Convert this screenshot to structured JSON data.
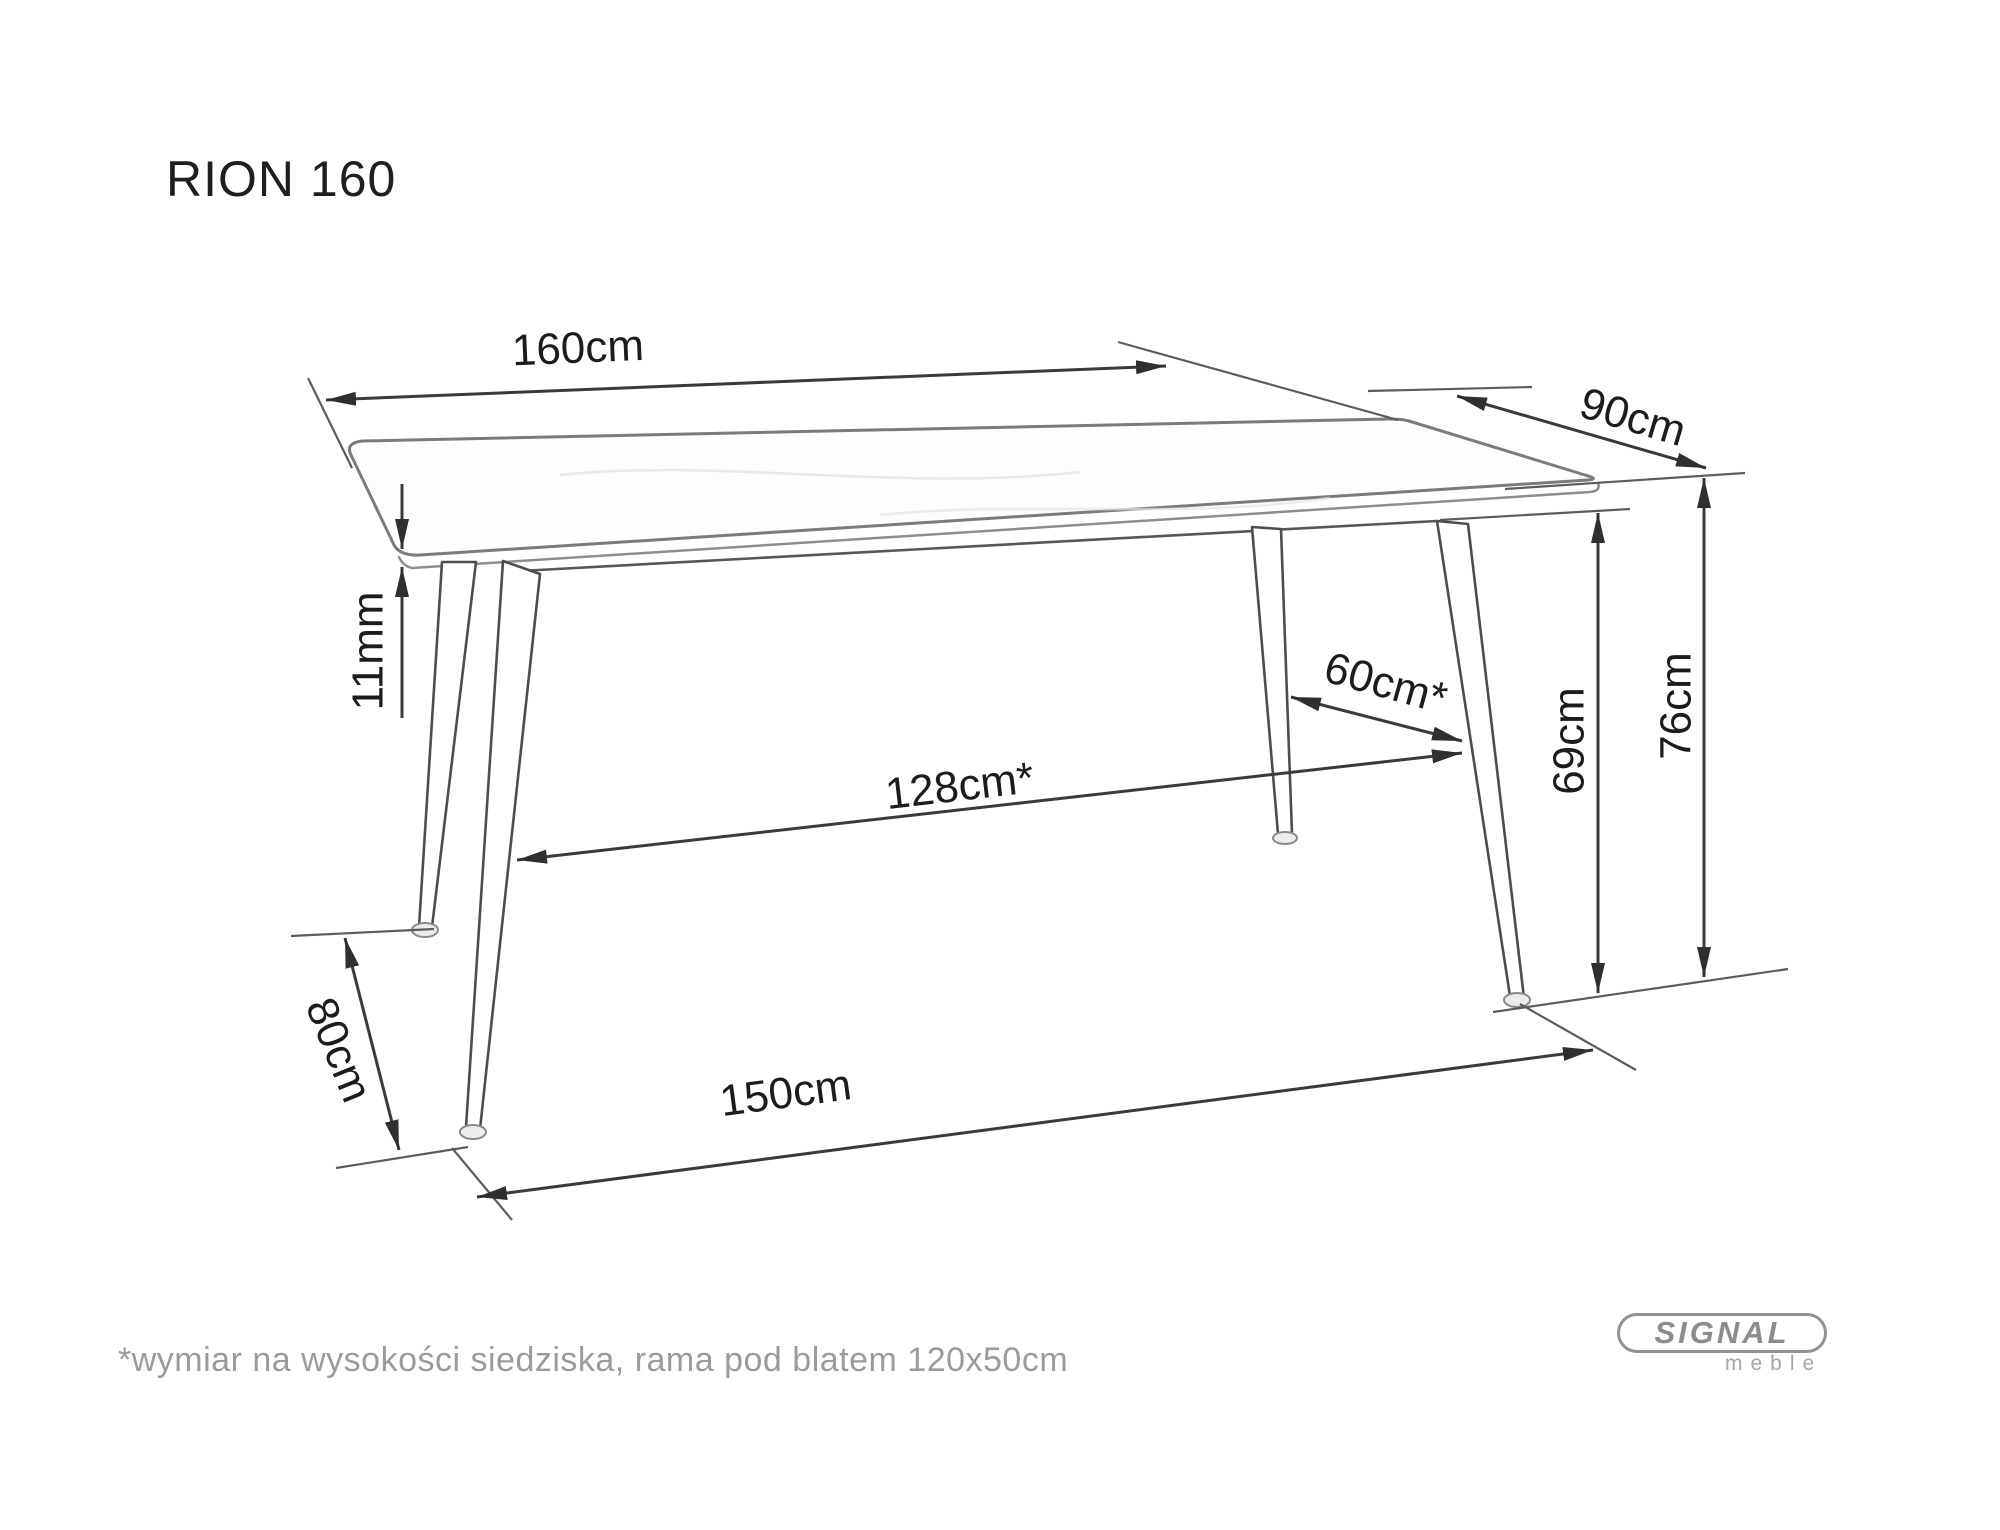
{
  "title": "RION 160",
  "dimensions": {
    "length_top": "160cm",
    "depth_top": "90cm",
    "top_thickness": "11mm",
    "leg_span_length": "128cm*",
    "leg_span_depth": "60cm*",
    "height_under_top": "69cm",
    "height_total": "76cm",
    "feet_span_depth": "80cm",
    "feet_span_length": "150cm"
  },
  "footnote": "*wymiar na wysokości siedziska, rama pod blatem 120x50cm",
  "logo": {
    "brand": "SIGNAL",
    "subtitle": "meble"
  },
  "colors": {
    "background": "#ffffff",
    "dimension_line": "#3a3a3a",
    "table_outline": "#7b7b7b",
    "label_text": "#1c1c1c",
    "muted_text": "#9b9b9b",
    "logo_gray": "#8c8c8c"
  }
}
